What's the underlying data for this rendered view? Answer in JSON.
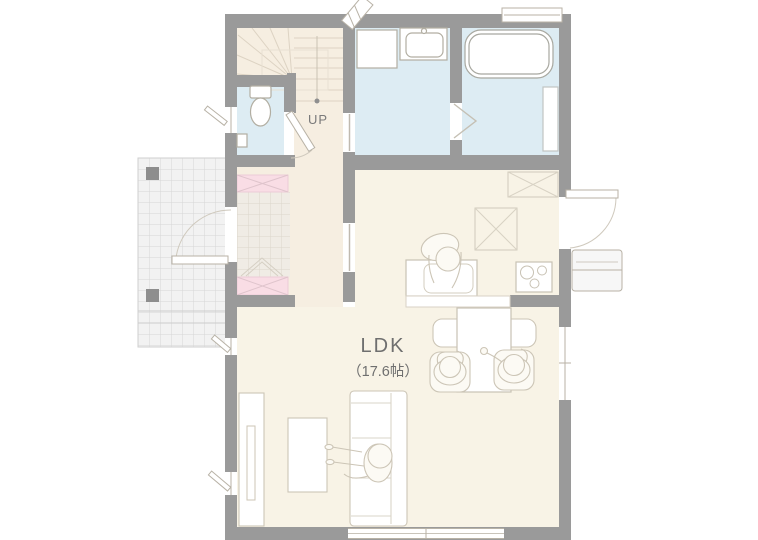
{
  "labels": {
    "room_name": "LDK",
    "room_size": "（17.6帖）",
    "stairs_direction": "UP"
  },
  "colors": {
    "wall": "#9a9a9a",
    "ldk_floor": "#f8f3e6",
    "hall_floor": "#f6eee1",
    "water_floor": "#ddecf3",
    "cabinet_pink": "#f9dde5",
    "porch_tile": "#f2f2f2",
    "fixture_outline": "#c8c2b4",
    "label_text": "#6f6f6f"
  },
  "fixtures": [
    "staircase",
    "toilet",
    "washing-machine-space",
    "vanity-basin",
    "bathtub",
    "bath-counter",
    "refrigerator",
    "cupboard",
    "kitchen-sink",
    "gas-stove",
    "kitchen-counter",
    "dining-table",
    "dining-bench",
    "dining-chair",
    "sofa",
    "low-table",
    "tv-board",
    "shoe-cabinet",
    "entrance-porch",
    "front-door",
    "back-door",
    "back-door-steps",
    "window",
    "person"
  ]
}
